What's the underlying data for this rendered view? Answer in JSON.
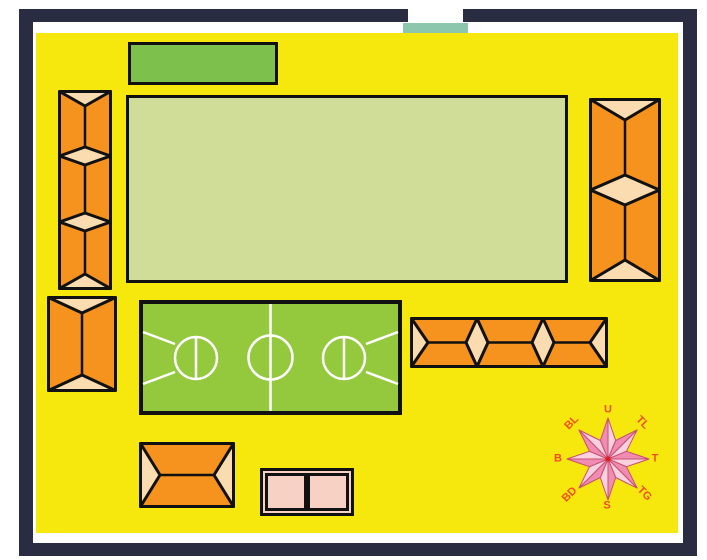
{
  "compass": {
    "labels": {
      "n": "U",
      "ne": "TL",
      "e": "T",
      "se": "TG",
      "s": "S",
      "sw": "BD",
      "w": "B",
      "nw": "BL"
    }
  },
  "colors": {
    "wall": "#2A2C41",
    "ground": "#F6E70C",
    "gate": "#8CC6AC",
    "stage": "#7DC04C",
    "field": "#CFDD99",
    "court": "#94C83D",
    "court-line": "#FFFFFF",
    "roof": "#F6921E",
    "roof-end": "#FBDCB0",
    "outline": "#111111",
    "annex": "#F7D1C3",
    "compass-light": "#FBD0DF",
    "compass-dark": "#F08CB2",
    "compass-stroke": "#C94F72",
    "compass-center": "#E02020",
    "compass-label": "#F04F24"
  }
}
